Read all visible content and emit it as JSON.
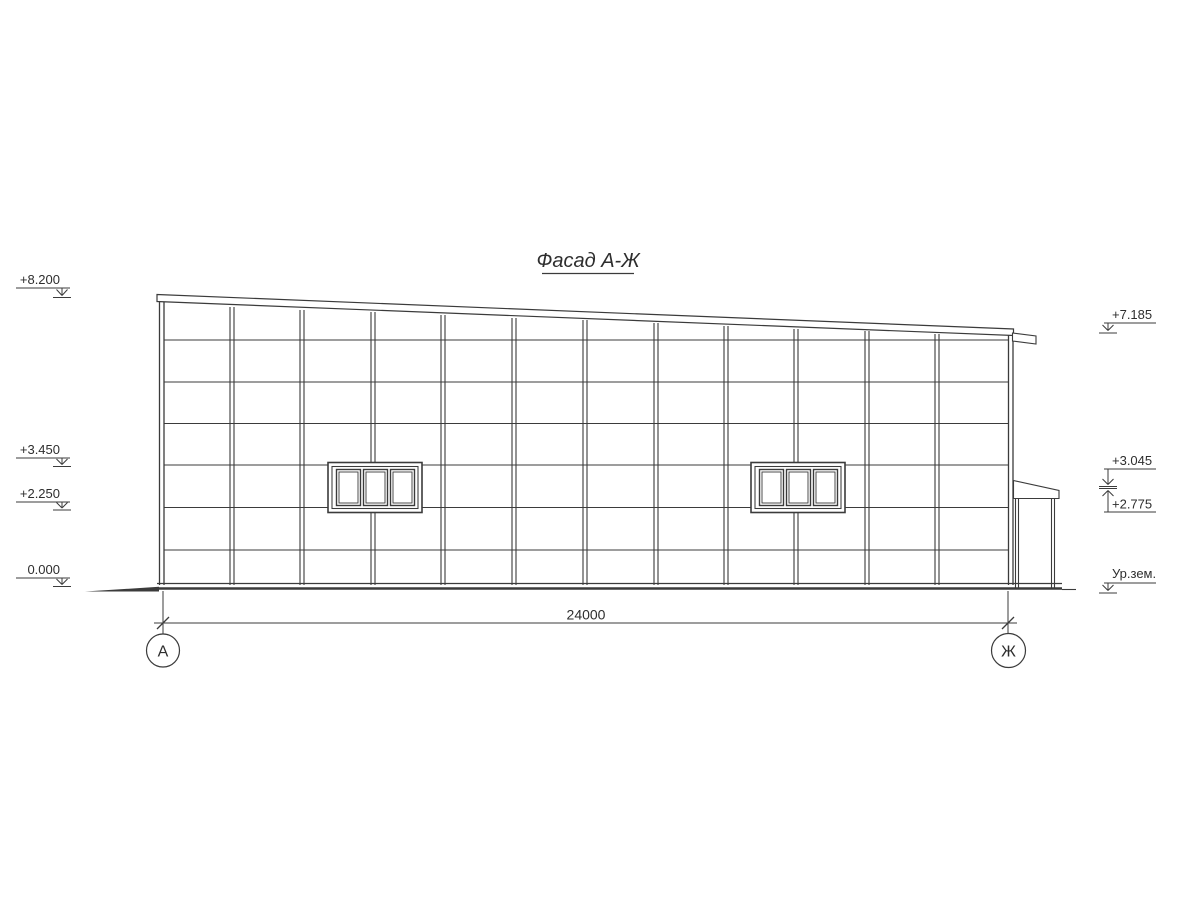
{
  "page": {
    "background": "#ffffff",
    "line_color": "#3b3b3b"
  },
  "title": {
    "text": "Фасад А-Ж"
  },
  "elevation_marks": {
    "left": [
      {
        "id": "level-roof-high",
        "value": "+8.200"
      },
      {
        "id": "level-window-top",
        "value": "+3.450"
      },
      {
        "id": "level-window-sill",
        "value": "+2.250"
      },
      {
        "id": "level-zero",
        "value": "0.000"
      }
    ],
    "right": [
      {
        "id": "level-roof-low",
        "value": "+7.185"
      },
      {
        "id": "level-annex-roof-top",
        "value": "+3.045"
      },
      {
        "id": "level-annex-roof-bottom",
        "value": "+2.775"
      },
      {
        "id": "level-ground",
        "value": "Ур.зем."
      }
    ]
  },
  "dimension": {
    "value": "24000"
  },
  "axes": {
    "left": "А",
    "right": "Ж"
  }
}
